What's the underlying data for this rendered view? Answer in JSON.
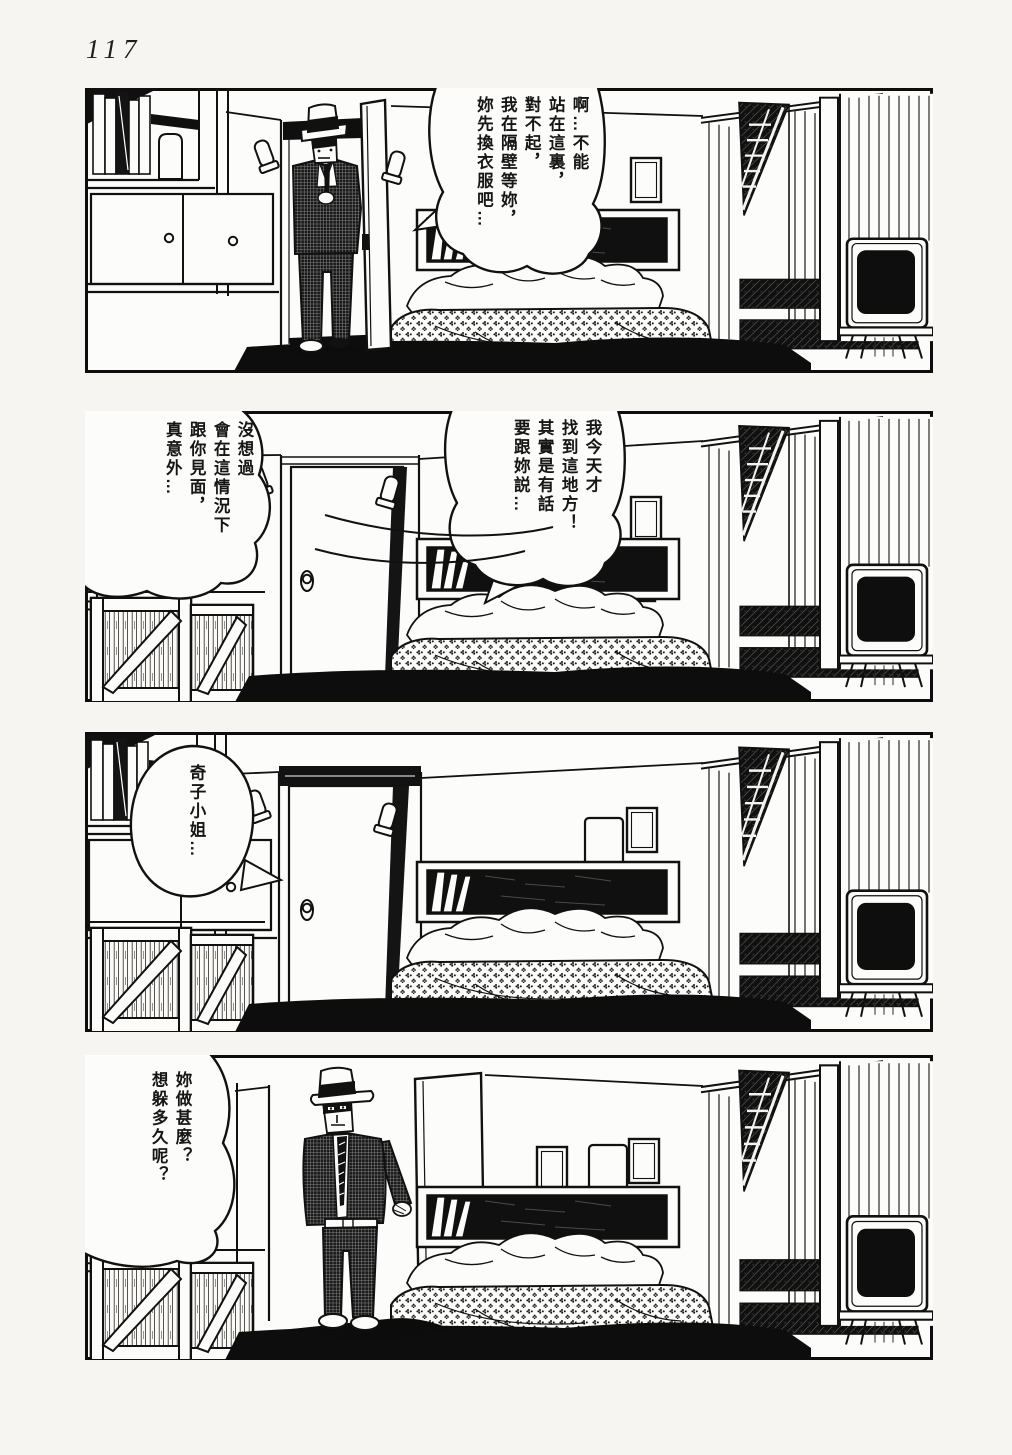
{
  "page": {
    "number": "117"
  },
  "colors": {
    "ink": "#141414",
    "paper": "#f6f5f1",
    "panel_bg": "#fcfcfa",
    "screen": "#0e0e0e"
  },
  "panels": [
    {
      "label": "panel-1",
      "bubbles": [
        {
          "speaker_hint": "man-in-doorway",
          "text": "啊…不能\n站在這裏，\n對不起，\n我在隔壁等妳，\n妳先換衣服吧…"
        }
      ]
    },
    {
      "label": "panel-2",
      "bubbles": [
        {
          "speaker_hint": "off-panel-right",
          "text": "我今天才\n找到這地方！\n其實是有話\n要跟妳説…"
        },
        {
          "speaker_hint": "off-panel-left",
          "text": "沒想過\n會在這情況下\n跟你見面，\n真意外…"
        }
      ]
    },
    {
      "label": "panel-3",
      "bubbles": [
        {
          "speaker_hint": "off-panel",
          "text": "奇子小姐…"
        }
      ]
    },
    {
      "label": "panel-4",
      "bubbles": [
        {
          "speaker_hint": "standing-man",
          "text": "妳做甚麼？\n想躲多久呢？"
        }
      ]
    }
  ]
}
